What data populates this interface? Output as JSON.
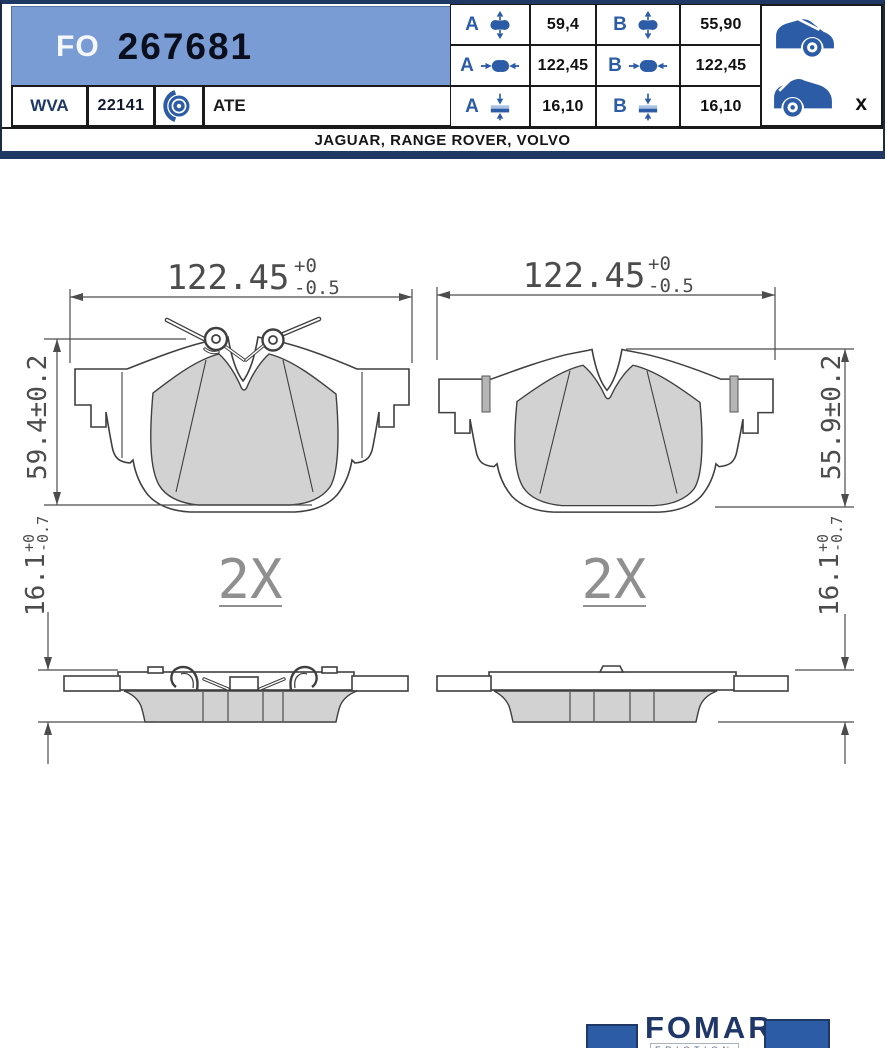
{
  "header": {
    "brand_code": "FO",
    "part_number": "267681",
    "wva_label": "WVA",
    "wva_number": "22141",
    "manufacturer": "ATE",
    "vehicles": "JAGUAR, RANGE ROVER, VOLVO",
    "rear_axle_marker": "x"
  },
  "specs": {
    "rows": [
      {
        "a_label": "A",
        "a_value": "59,4",
        "b_label": "B",
        "b_value": "55,90"
      },
      {
        "a_label": "A",
        "a_value": "122,45",
        "b_label": "B",
        "b_value": "122,45"
      },
      {
        "a_label": "A",
        "a_value": "16,10",
        "b_label": "B",
        "b_value": "16,10"
      }
    ]
  },
  "drawing": {
    "left_pad": {
      "width_value": "122.45",
      "width_tol_plus": "+0",
      "width_tol_minus": "-0.5",
      "height_value": "59.4±0.2",
      "thickness_value": "16.1",
      "thickness_tol_plus": "+0",
      "thickness_tol_minus": "-0.7",
      "quantity": "2X"
    },
    "right_pad": {
      "width_value": "122.45",
      "width_tol_plus": "+0",
      "width_tol_minus": "-0.5",
      "height_value": "55.9±0.2",
      "thickness_value": "16.1",
      "thickness_tol_plus": "+0",
      "thickness_tol_minus": "-0.7",
      "quantity": "2X"
    }
  },
  "footer": {
    "brand": "FOMAR",
    "sub_brand": "FRICTION"
  },
  "colors": {
    "header_blue": "#7a9cd4",
    "navy": "#1f3864",
    "icon_blue": "#2d5ca6"
  }
}
